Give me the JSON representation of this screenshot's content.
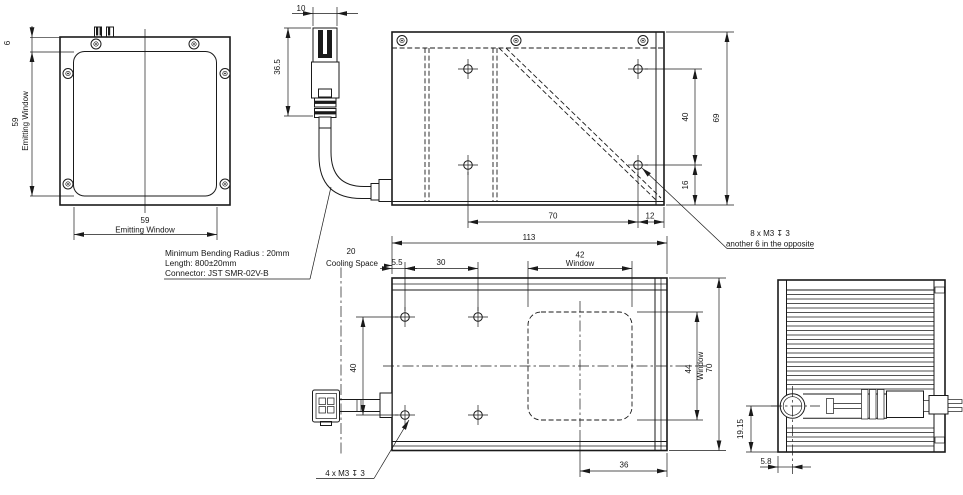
{
  "front": {
    "offset": "6",
    "height": "59",
    "height_label": "Emitting Window",
    "width": "59",
    "width_label": "Emitting Window"
  },
  "connector": {
    "width": "10",
    "height": "36.5"
  },
  "cable_notes": {
    "line1": "Minimum Bending Radius : 20mm",
    "line2": "Length: 800±20mm",
    "line3": "Connector: JST SMR-02V-B"
  },
  "top": {
    "hole_spacing_v": "40",
    "hole_to_edge": "16",
    "height": "69",
    "hole_spacing_h": "70",
    "hole_to_right": "12",
    "thread_note_line1": "8 x M3 ↧ 3",
    "thread_note_line2": "another 6 in the opposite"
  },
  "bottom": {
    "length": "113",
    "cooling": "20",
    "cooling_label": "Cooling Space",
    "edge": "5.5",
    "hole_spacing_h": "30",
    "window_w": "42",
    "window_w_label": "Window",
    "hole_spacing_v": "40",
    "window_h": "44",
    "window_h_label": "Window",
    "height": "70",
    "window_to_edge": "36",
    "thread_note": "4 x M3 ↧ 3"
  },
  "side": {
    "cable_to_bottom": "19.15",
    "cable_to_left": "5.8"
  }
}
